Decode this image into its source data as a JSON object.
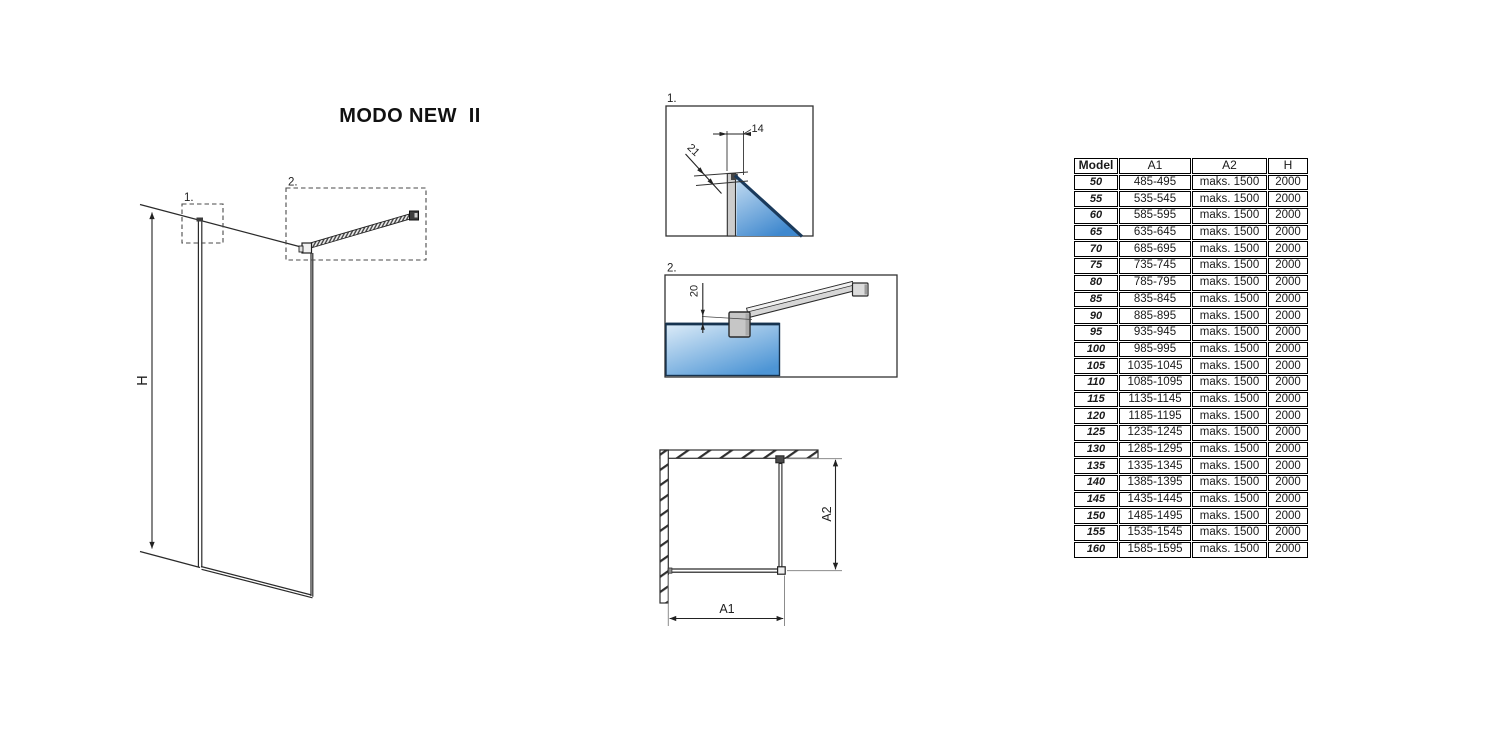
{
  "title": "MODO NEW  II",
  "main_drawing": {
    "height_label": "H",
    "marker_1": "1.",
    "marker_2": "2."
  },
  "detail_1": {
    "label": "1.",
    "dim_top_width": "14",
    "dim_profile_depth": "21"
  },
  "detail_2": {
    "label": "2.",
    "dim_bar_offset": "20"
  },
  "top_view": {
    "width_label": "A1",
    "depth_label": "A2"
  },
  "table": {
    "headers": {
      "model": "Model",
      "a1": "A1",
      "a2": "A2",
      "h": "H"
    },
    "rows": [
      {
        "model": "50",
        "a1": "485-495",
        "a2": "maks. 1500",
        "h": "2000"
      },
      {
        "model": "55",
        "a1": "535-545",
        "a2": "maks. 1500",
        "h": "2000"
      },
      {
        "model": "60",
        "a1": "585-595",
        "a2": "maks. 1500",
        "h": "2000"
      },
      {
        "model": "65",
        "a1": "635-645",
        "a2": "maks. 1500",
        "h": "2000"
      },
      {
        "model": "70",
        "a1": "685-695",
        "a2": "maks. 1500",
        "h": "2000"
      },
      {
        "model": "75",
        "a1": "735-745",
        "a2": "maks. 1500",
        "h": "2000"
      },
      {
        "model": "80",
        "a1": "785-795",
        "a2": "maks. 1500",
        "h": "2000"
      },
      {
        "model": "85",
        "a1": "835-845",
        "a2": "maks. 1500",
        "h": "2000"
      },
      {
        "model": "90",
        "a1": "885-895",
        "a2": "maks. 1500",
        "h": "2000"
      },
      {
        "model": "95",
        "a1": "935-945",
        "a2": "maks. 1500",
        "h": "2000"
      },
      {
        "model": "100",
        "a1": "985-995",
        "a2": "maks. 1500",
        "h": "2000"
      },
      {
        "model": "105",
        "a1": "1035-1045",
        "a2": "maks. 1500",
        "h": "2000"
      },
      {
        "model": "110",
        "a1": "1085-1095",
        "a2": "maks. 1500",
        "h": "2000"
      },
      {
        "model": "115",
        "a1": "1135-1145",
        "a2": "maks. 1500",
        "h": "2000"
      },
      {
        "model": "120",
        "a1": "1185-1195",
        "a2": "maks. 1500",
        "h": "2000"
      },
      {
        "model": "125",
        "a1": "1235-1245",
        "a2": "maks. 1500",
        "h": "2000"
      },
      {
        "model": "130",
        "a1": "1285-1295",
        "a2": "maks. 1500",
        "h": "2000"
      },
      {
        "model": "135",
        "a1": "1335-1345",
        "a2": "maks. 1500",
        "h": "2000"
      },
      {
        "model": "140",
        "a1": "1385-1395",
        "a2": "maks. 1500",
        "h": "2000"
      },
      {
        "model": "145",
        "a1": "1435-1445",
        "a2": "maks. 1500",
        "h": "2000"
      },
      {
        "model": "150",
        "a1": "1485-1495",
        "a2": "maks. 1500",
        "h": "2000"
      },
      {
        "model": "155",
        "a1": "1535-1545",
        "a2": "maks. 1500",
        "h": "2000"
      },
      {
        "model": "160",
        "a1": "1585-1595",
        "a2": "maks. 1500",
        "h": "2000"
      }
    ]
  },
  "colors": {
    "glass_light": "#dcebf8",
    "glass_dark": "#4189cf",
    "profile_gray": "#c9c9c9",
    "line": "#2a2a2a"
  }
}
